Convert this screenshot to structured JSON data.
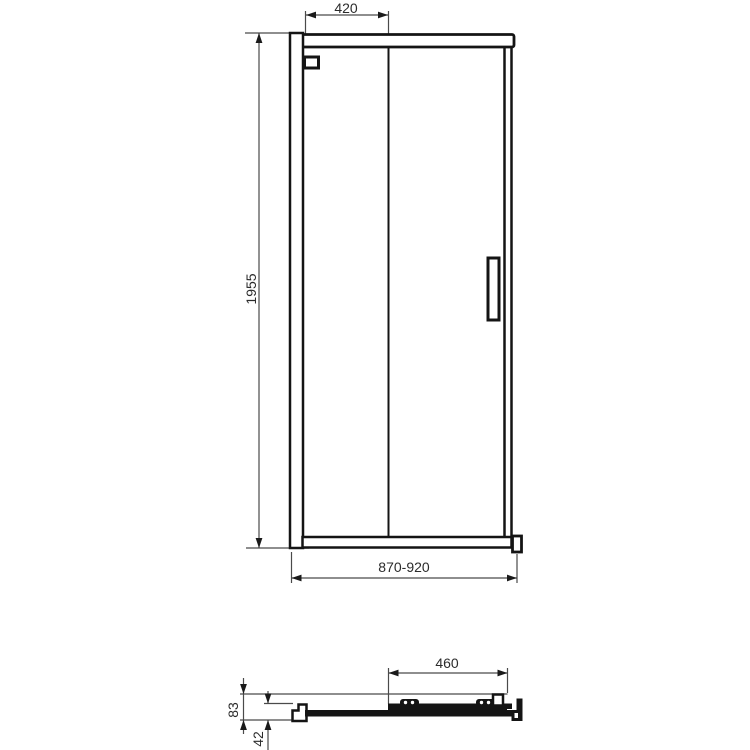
{
  "drawing": {
    "title": "shower-sliding-door-dimension-drawing",
    "front_view": {
      "dim_top_width": "420",
      "dim_height": "1955",
      "dim_bottom_width": "870-920"
    },
    "section_view": {
      "dim_door_panel_width": "460",
      "dim_total_depth": "83",
      "dim_profile_depth": "42"
    },
    "colors": {
      "background": "#ffffff",
      "outline": "#141414",
      "dimension_line": "#4a4a4a",
      "text": "#2b2b2b"
    }
  }
}
